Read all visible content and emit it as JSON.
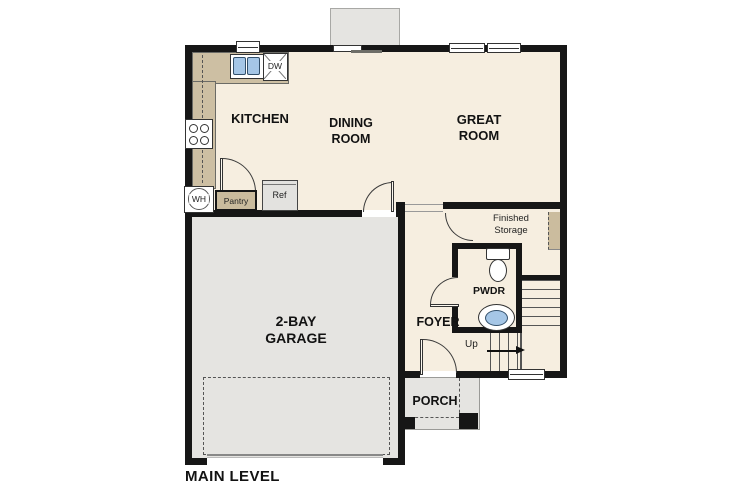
{
  "title": "MAIN LEVEL",
  "colors": {
    "wall": "#161616",
    "floor_cream": "#f6eee0",
    "area_gray": "#e5e4e1",
    "counter_tan": "#cdbfa3",
    "sink_blue": "#a5c6e6"
  },
  "rooms": {
    "kitchen": {
      "label": "KITCHEN"
    },
    "dining": {
      "line1": "DINING",
      "line2": "ROOM"
    },
    "great": {
      "line1": "GREAT",
      "line2": "ROOM"
    },
    "garage": {
      "line1": "2-BAY",
      "line2": "GARAGE"
    },
    "foyer": {
      "label": "FOYER"
    },
    "pwdr": {
      "label": "PWDR"
    },
    "porch": {
      "label": "PORCH"
    },
    "storage": {
      "line1": "Finished",
      "line2": "Storage"
    }
  },
  "fixtures": {
    "dw": "DW",
    "wh": "WH",
    "pantry": "Pantry",
    "ref": "Ref",
    "up": "Up"
  }
}
